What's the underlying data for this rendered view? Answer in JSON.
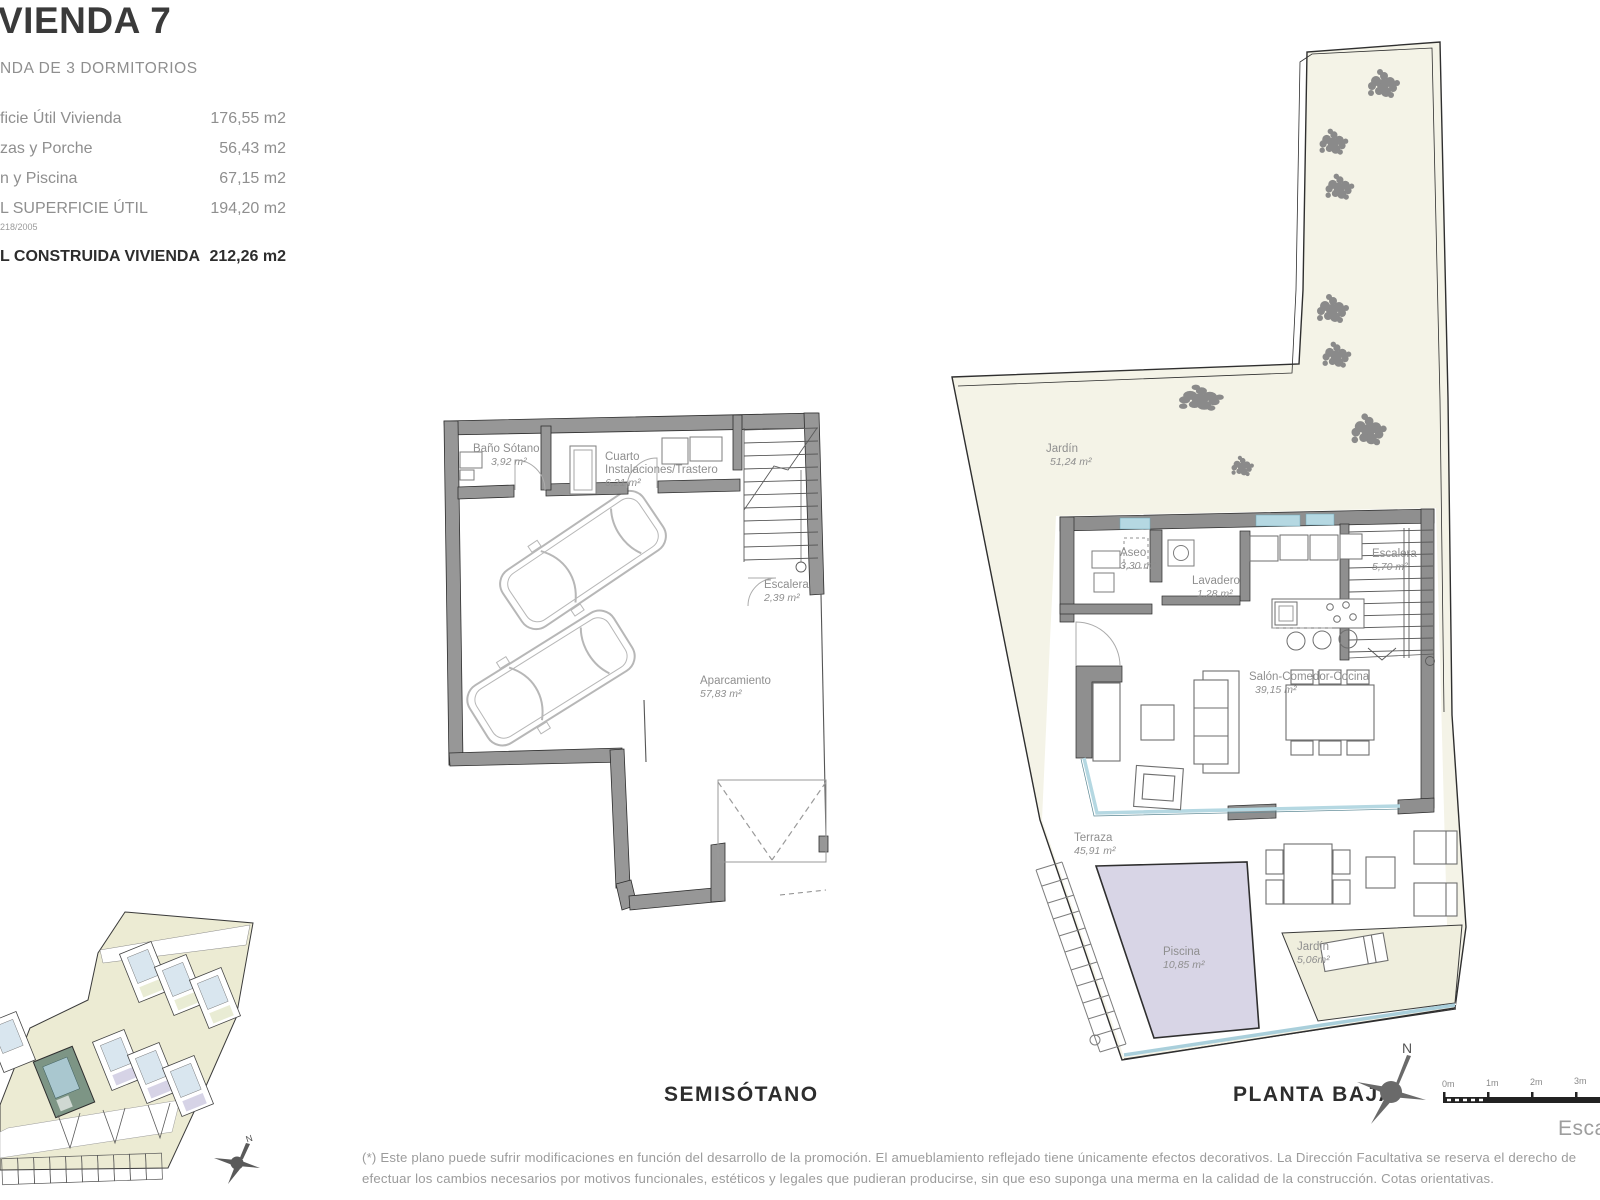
{
  "info": {
    "title": "VIENDA 7",
    "subtitle": "NDA DE 3 DORMITORIOS",
    "rows": [
      {
        "label": "ficie Útil Vivienda",
        "value": "176,55 m2"
      },
      {
        "label": "zas y Porche",
        "value": "56,43 m2"
      },
      {
        "label": "n y Piscina",
        "value": "67,15 m2"
      },
      {
        "label": "L SUPERFICIE ÚTIL",
        "value": "194,20 m2"
      }
    ],
    "note": "218/2005",
    "total_label": "L CONSTRUIDA VIVIENDA",
    "total_value": "212,26 m2"
  },
  "semisotano": {
    "caption": "SEMISÓTANO",
    "bano": {
      "name": "Baño Sótano",
      "area": "3,92 m²"
    },
    "cuarto": {
      "line1": "Cuarto",
      "line2": "Instalaciones/Trastero",
      "area": "6,21 m²"
    },
    "escalera": {
      "name": "Escalera",
      "area": "2,39 m²"
    },
    "aparcamiento": {
      "name": "Aparcamiento",
      "area": "57,83 m²"
    }
  },
  "plantabaja": {
    "caption": "PLANTA BAJA",
    "jardin": {
      "name": "Jardín",
      "area": "51,24 m²"
    },
    "aseo": {
      "name": "Aseo",
      "area": "3,30 m²"
    },
    "lavadero": {
      "name": "Lavadero",
      "area": "1,28 m²"
    },
    "escalera": {
      "name": "Escalera",
      "area": "5,70 m²"
    },
    "salon": {
      "name": "Salón-Comedor-Cocina",
      "area": "39,15 m²"
    },
    "terraza": {
      "name": "Terraza",
      "area": "45,91 m²"
    },
    "piscina": {
      "name": "Piscina",
      "area": "10,85 m²"
    },
    "jardin2": {
      "name": "Jardín",
      "area": "5,06m²"
    }
  },
  "compass": {
    "north": "N"
  },
  "minimap_compass": {
    "north": "N"
  },
  "scalebar": {
    "ticks": [
      "0m",
      "1m",
      "2m",
      "3m"
    ],
    "caption": "Escala"
  },
  "footnote": {
    "line1": "(*) Este plano puede sufrir modificaciones en función del desarrollo de la promoción. El amueblamiento reflejado tiene únicamente efectos decorativos. La Dirección Facultativa se reserva el derecho de",
    "line2": "efectuar los cambios necesarios por motivos funcionales, estéticos y legales que pudieran producirse, sin que eso suponga una merma en la calidad de la construcción. Cotas orientativas."
  },
  "colors": {
    "wall_gray": "#8f8f8f",
    "garden_cream": "#f4f3e7",
    "pool_lavender": "#d8d5e6",
    "glass_blue": "#b5d8e2",
    "highlight_unit_green": "#7d9585",
    "text_dark": "#3a3a3a",
    "text_gray": "#8f8f8f"
  }
}
